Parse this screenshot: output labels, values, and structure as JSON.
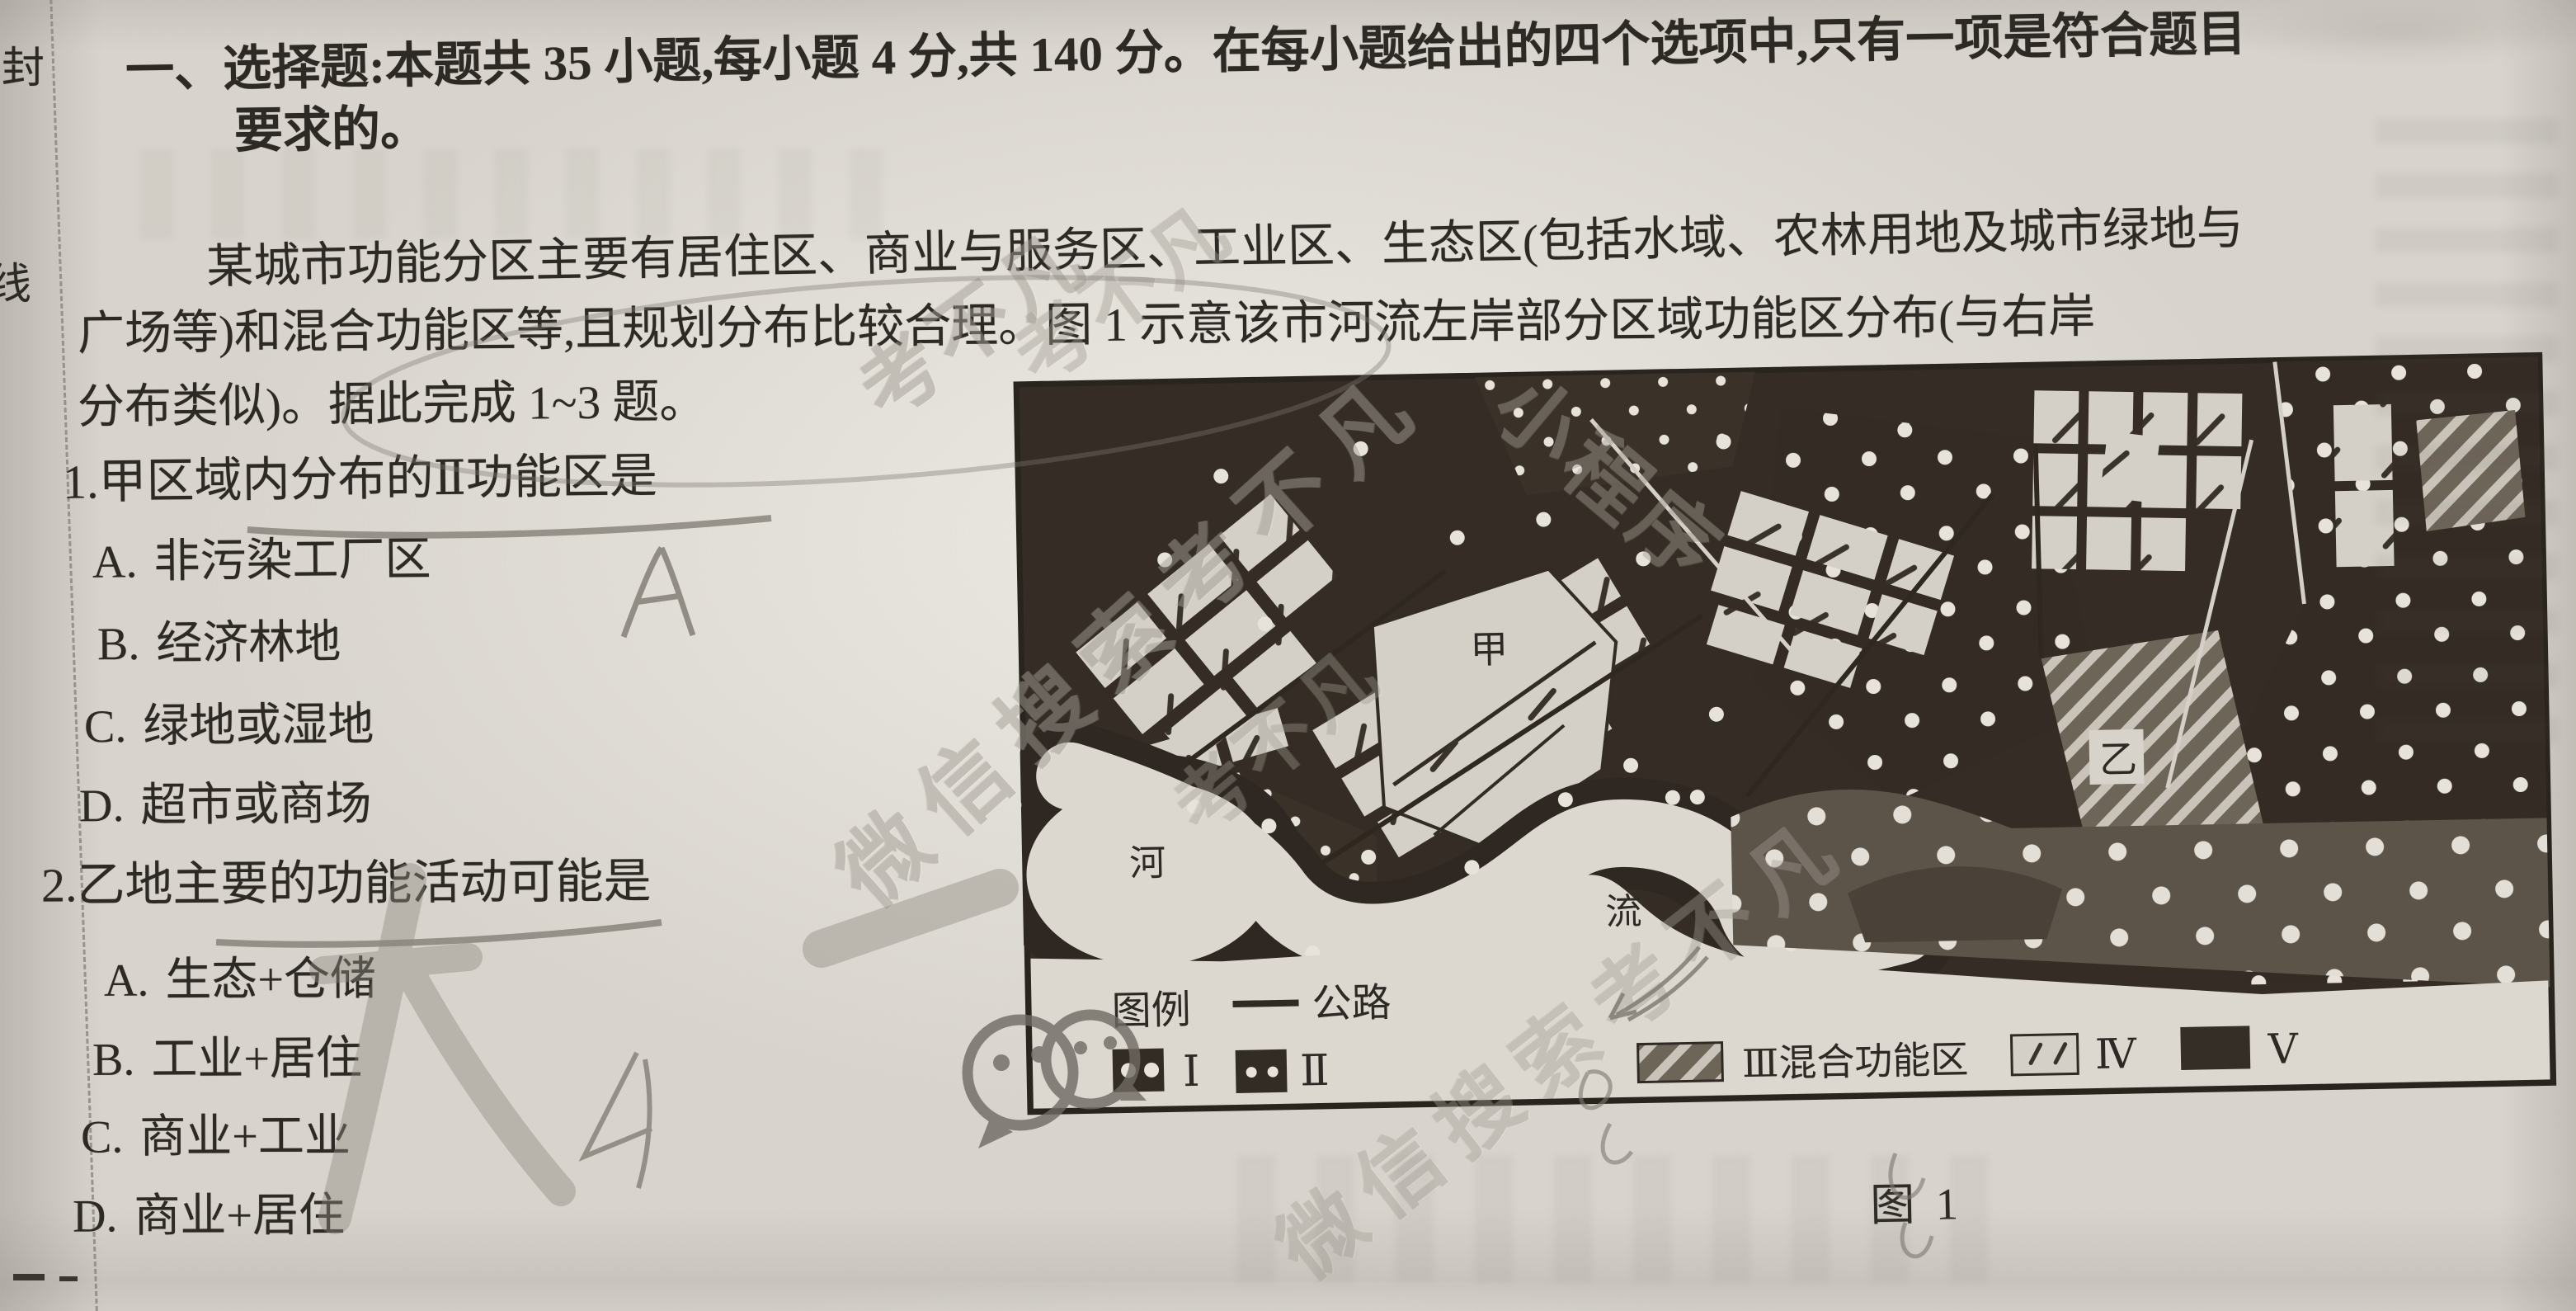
{
  "seal": {
    "top": "封",
    "bottom": "线"
  },
  "header": {
    "line1": "一、选择题:本题共 35 小题,每小题 4 分,共 140 分。在每小题给出的四个选项中,只有一项是符合题目",
    "line2": "要求的。"
  },
  "passage": {
    "line1": "某城市功能分区主要有居住区、商业与服务区、工业区、生态区(包括水域、农林用地及城市绿地与",
    "line2": "广场等)和混合功能区等,且规划分布比较合理。图 1 示意该市河流左岸部分区域功能区分布(与右岸",
    "line3": "分布类似)。据此完成 1~3 题。"
  },
  "questions": [
    {
      "number": "1.",
      "stem": "甲区域内分布的Ⅱ功能区是",
      "options": [
        {
          "label": "A.",
          "text": "非污染工厂区"
        },
        {
          "label": "B.",
          "text": "经济林地"
        },
        {
          "label": "C.",
          "text": "绿地或湿地"
        },
        {
          "label": "D.",
          "text": "超市或商场"
        }
      ]
    },
    {
      "number": "2.",
      "stem": "乙地主要的功能活动可能是",
      "options": [
        {
          "label": "A.",
          "text": "生态+仓储"
        },
        {
          "label": "B.",
          "text": "工业+居住"
        },
        {
          "label": "C.",
          "text": "商业+工业"
        },
        {
          "label": "D.",
          "text": "商业+居住"
        }
      ]
    }
  ],
  "figure": {
    "caption": "图 1",
    "labels": {
      "river_char_upper": "河",
      "river_char_lower": "流",
      "zone_jia": "甲",
      "zone_yi": "乙"
    },
    "legend": {
      "title": "图例",
      "road": "公路",
      "items": [
        {
          "symbol": "dark-box-two-large-white-dots",
          "label": "Ⅰ"
        },
        {
          "symbol": "dark-box-two-small-white-dots",
          "label": "Ⅱ"
        },
        {
          "symbol": "diagonal-hatch-box",
          "label": "Ⅲ混合功能区"
        },
        {
          "symbol": "light-box-sparse-slashes",
          "label": "Ⅳ"
        },
        {
          "symbol": "solid-dark-box",
          "label": "Ⅴ"
        }
      ]
    }
  },
  "annotations": {
    "q1_answer": "A"
  },
  "watermarks": {
    "brand": "考不凡",
    "search_line": "微信搜索考不凡",
    "mini_program": "小程序",
    "logo": "wechat-logo"
  },
  "colors": {
    "paper": "#d8d4cd",
    "ink": "#2d2a26",
    "pencil": "#7e7970",
    "map_dark": "#352d25",
    "map_mid": "#5d5449",
    "map_light": "#d5d0c7",
    "watermark_gray": "#a39e95"
  }
}
